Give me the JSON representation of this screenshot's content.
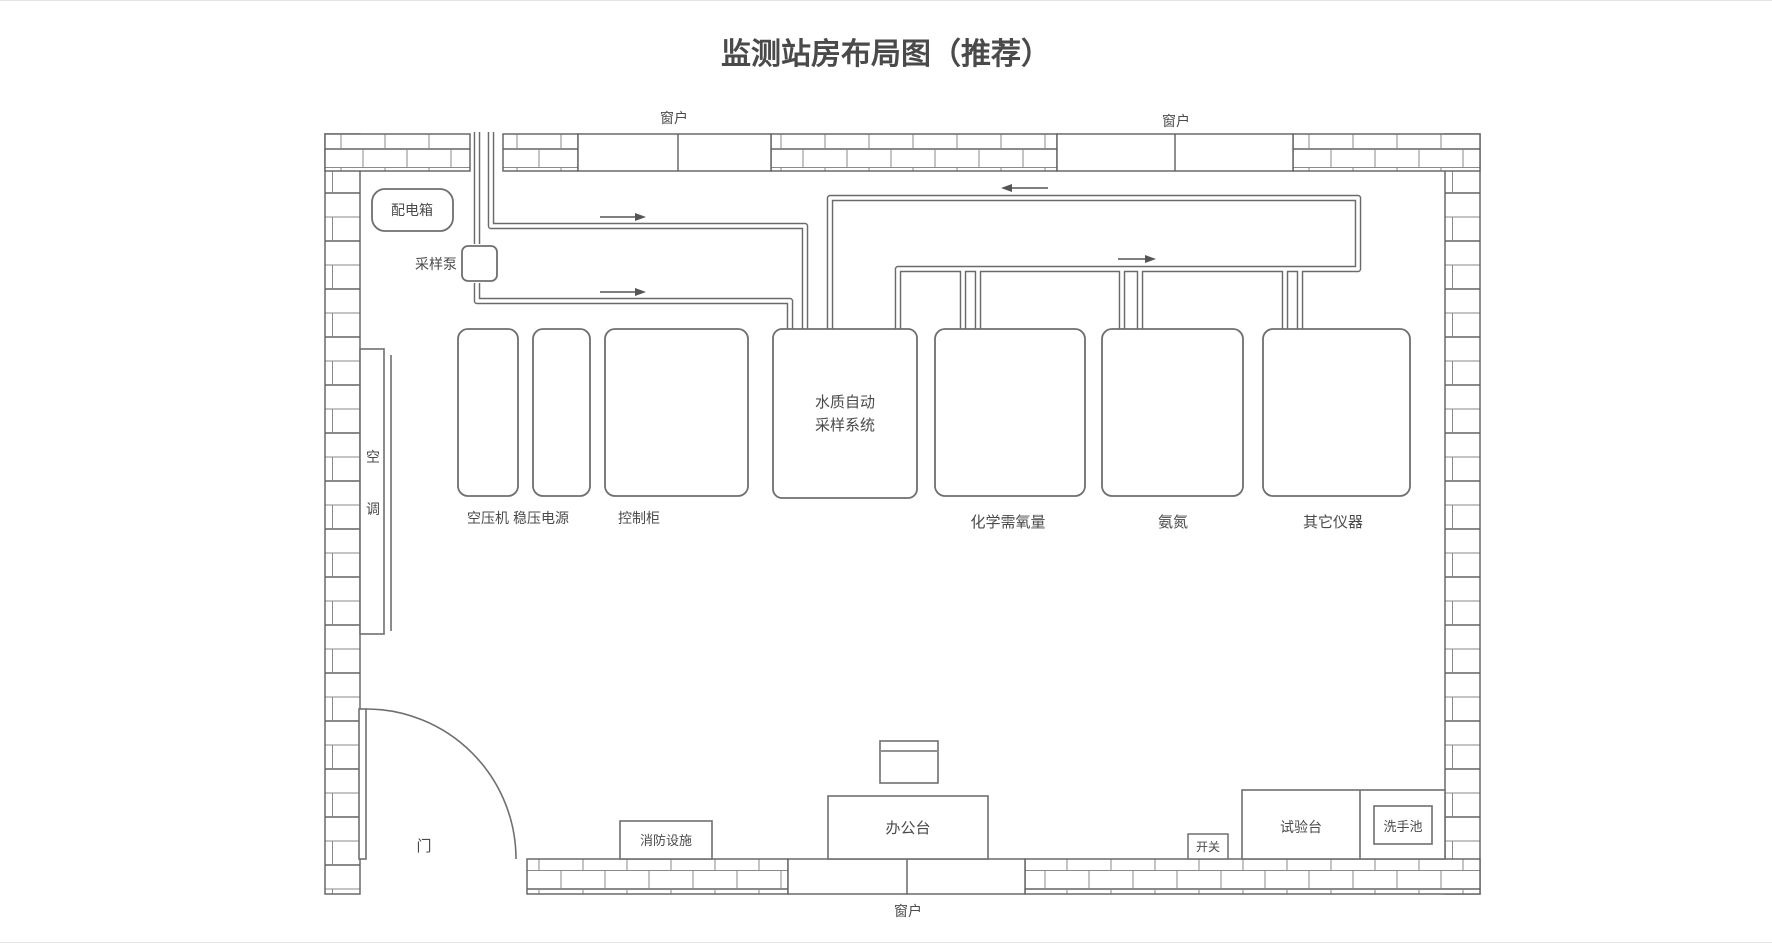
{
  "title": "监测站房布局图（推荐）",
  "colors": {
    "title": "#2e5c8e",
    "wall_line": "#5f5f5f",
    "pipe_line": "#6a6a6a",
    "label_text": "#4a4a4a"
  },
  "windows": {
    "top_left": "窗户",
    "top_right": "窗户",
    "bottom": "窗户"
  },
  "electrical": {
    "distribution_box": "配电箱",
    "sampling_pump": "采样泵",
    "switch": "开关"
  },
  "hvac": {
    "air_conditioner": [
      "空",
      "调"
    ]
  },
  "equipment": {
    "air_compressor": "空压机",
    "voltage_stabilizer": "稳压电源",
    "control_cabinet": "控制柜",
    "water_sampling_system": [
      "水质自动",
      "采样系统"
    ],
    "cod_analyzer": "化学需氧量",
    "ammonia_analyzer": "氨氮",
    "other_instruments": "其它仪器"
  },
  "furniture": {
    "door": "门",
    "fire_equipment": "消防设施",
    "office_desk": "办公台",
    "test_bench": "试验台",
    "sink": "洗手池"
  }
}
